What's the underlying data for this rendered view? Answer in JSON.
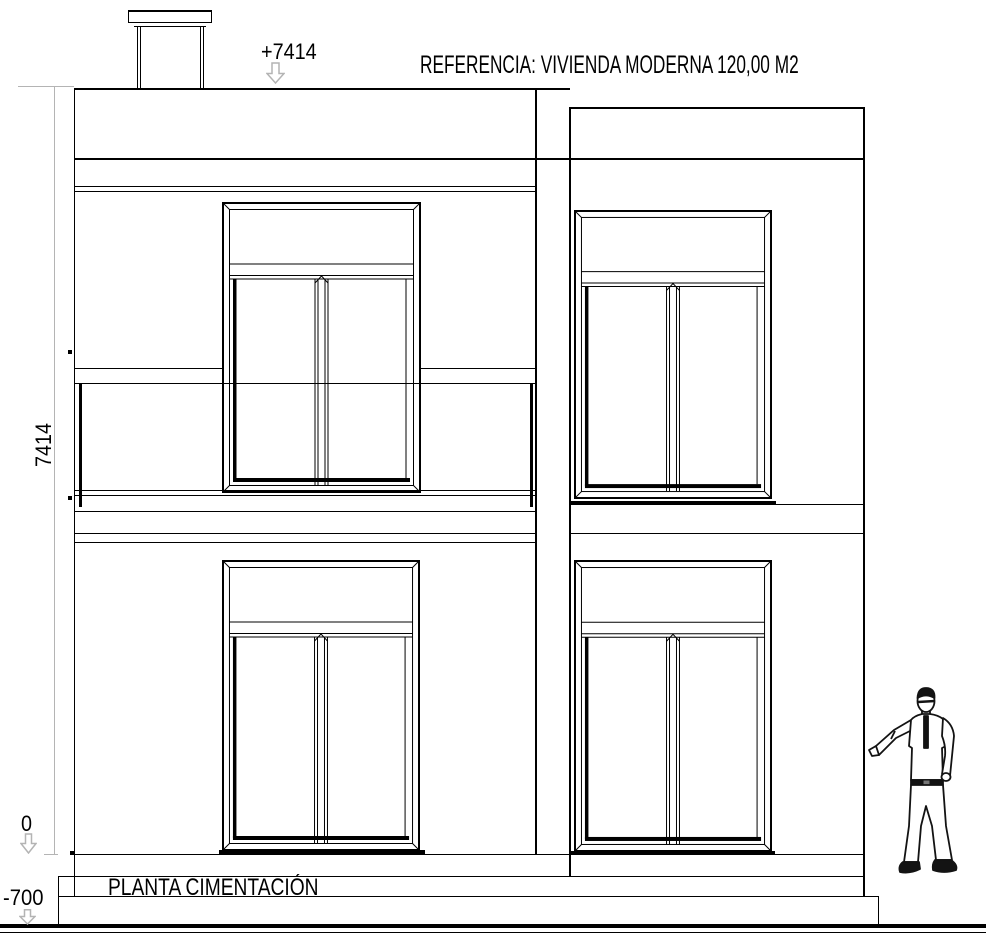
{
  "header": {
    "title": "REFERENCIA: VIVIENDA MODERNA 120,00 M2"
  },
  "annotations": {
    "roof_level": "+7414",
    "height_dimension": "7414",
    "ground_level": "0",
    "foundation_level": "-700",
    "foundation_plan_label": "PLANTA CIMENTACIÓN"
  },
  "icons": {
    "down_arrow": "outline-down-arrow",
    "figure": "standing-man"
  },
  "colors": {
    "ink": "#000000",
    "dimension": "#b4b4b4",
    "background": "#ffffff"
  }
}
